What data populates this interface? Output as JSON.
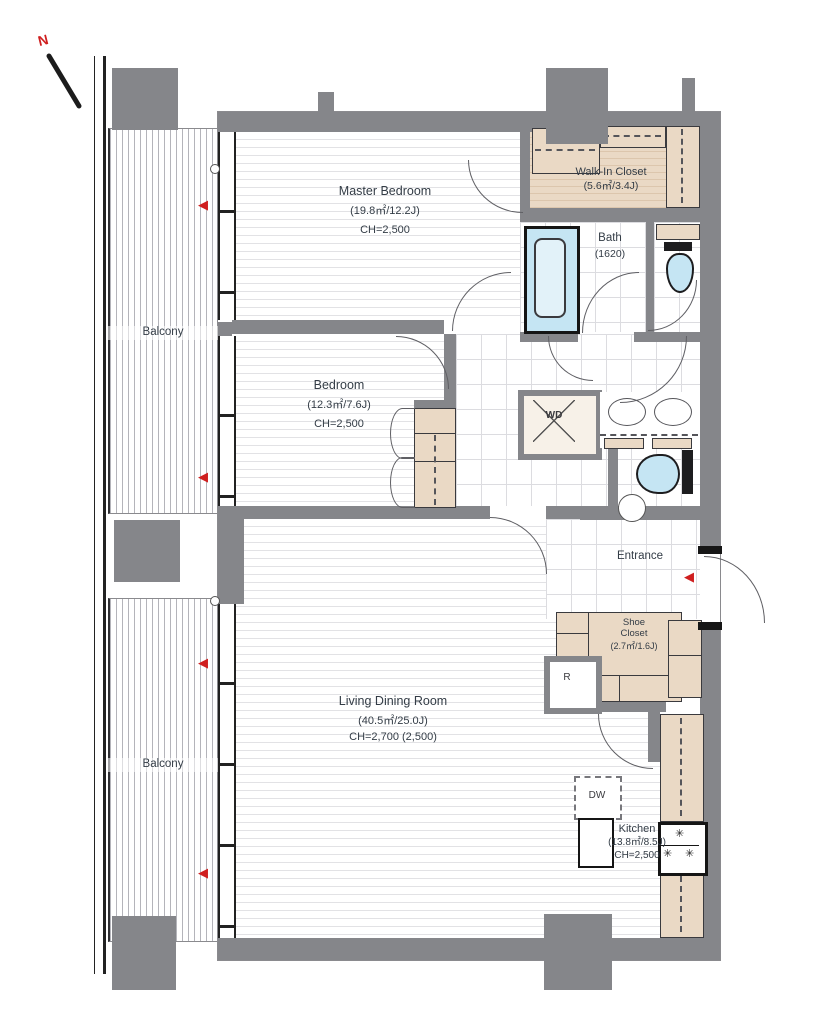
{
  "north": {
    "label": "N"
  },
  "balconies": {
    "upper": "Balcony",
    "lower": "Balcony"
  },
  "rooms": {
    "master_bedroom": {
      "name": "Master Bedroom",
      "area": "(19.8㎡/12.2J)",
      "ceiling": "CH=2,500"
    },
    "walk_in_closet": {
      "name": "Walk-In Closet",
      "area": "(5.6㎡/3.4J)"
    },
    "bath": {
      "name": "Bath",
      "size": "(1620)"
    },
    "bedroom": {
      "name": "Bedroom",
      "area": "(12.3㎡/7.6J)",
      "ceiling": "CH=2,500"
    },
    "entrance": {
      "name": "Entrance"
    },
    "shoe_closet": {
      "name": "Shoe Closet",
      "area": "(2.7㎡/1.6J)"
    },
    "living_dining": {
      "name": "Living Dining Room",
      "area": "(40.5㎡/25.0J)",
      "ceiling": "CH=2,700 (2,500)"
    },
    "kitchen": {
      "name": "Kitchen",
      "area": "(13.8㎡/8.5J)",
      "ceiling": "CH=2,500"
    }
  },
  "appliances": {
    "washer_dryer": "WD",
    "dishwasher": "DW",
    "refrigerator": "R"
  },
  "icons": {
    "burner": "✳",
    "evacuation_arrow": "◀"
  },
  "colors": {
    "wall": "#85868a",
    "closet_fill": "#ead9c5",
    "fixture_blue": "#c5e5f3",
    "arrow_red": "#cf1f1f",
    "text": "#333c46"
  }
}
